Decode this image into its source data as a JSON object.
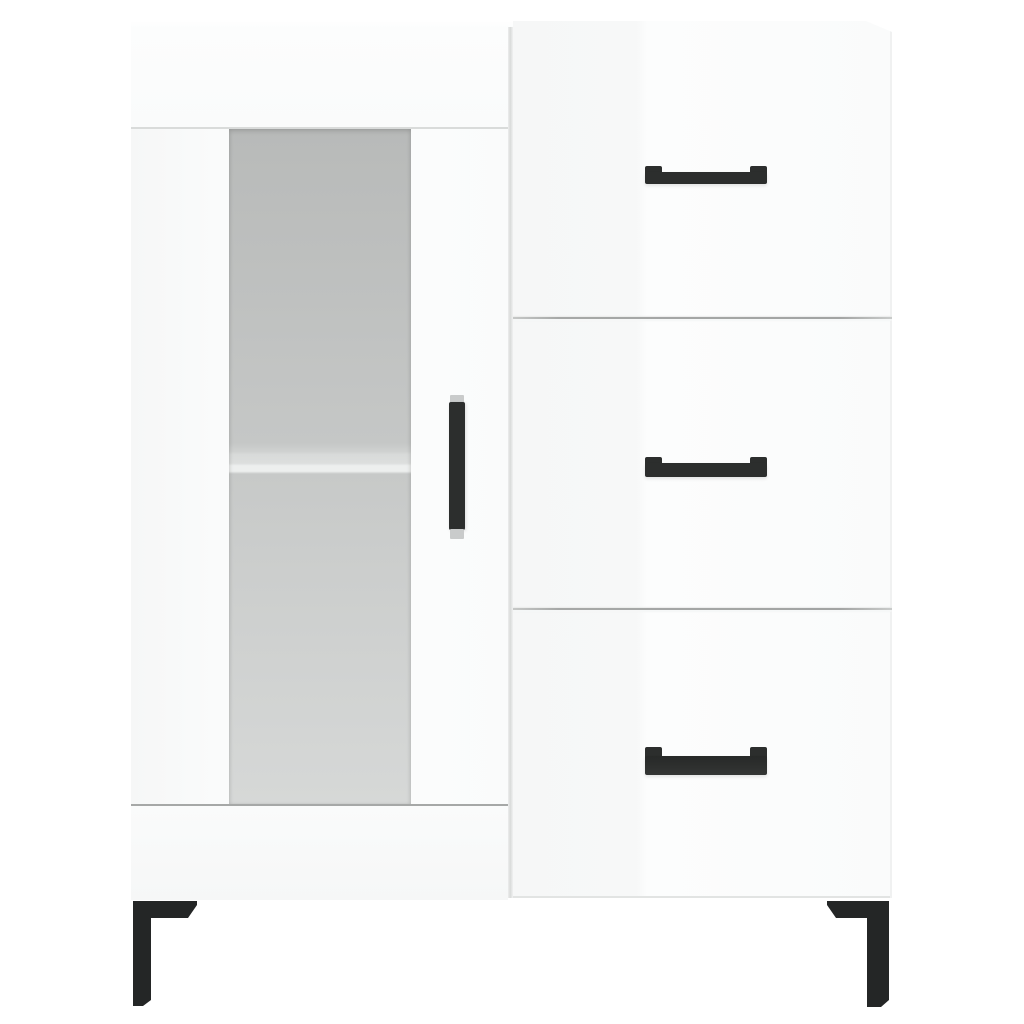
{
  "scene": {
    "type": "product-photo",
    "description": "Studio product photograph of a white high-gloss sideboard (highboard) with a frosted-glass door on the left, three drawers on the right, black bar handles and black metal corner legs, on a plain white background"
  },
  "colors": {
    "bg": "#ffffff",
    "body": "#fafbfb",
    "body-bright": "#fcfdfd",
    "body-shade": "#f6f7f7",
    "rail-line": "#d9dbda",
    "gap-line": "#a6a8a7",
    "bottom-line": "#e2e4e3",
    "edge-soft": "#f0f1f1",
    "glass-top": "#b8bab9",
    "glass-mid": "#c5c7c6",
    "shelf-face": "#d8dad9",
    "shelf-highlight": "#edefee",
    "glass-lower": "#c7c9c8",
    "glass-bottom": "#d6d8d7",
    "handle": "#2c2e2d",
    "handle-mount": "#c9cbcb",
    "leg": "#242626"
  },
  "cabinet": {
    "label": "white sideboard with glass door and three drawers",
    "top_surface_label": "cabinet top surface",
    "door_section": {
      "label": "left door section",
      "top_rail_label": "top rail above door",
      "door_label": "glass door",
      "glass_label": "frosted glass panel",
      "shelf_label": "shelf edge seen through glass",
      "handle_label": "vertical black door handle",
      "bottom_rail_label": "bottom rail below door"
    },
    "divider_label": "gap between door and drawers",
    "drawer_section": {
      "label": "right drawer section",
      "drawers": [
        {
          "label": "top drawer",
          "handle_label": "black bar handle of top drawer"
        },
        {
          "label": "middle drawer",
          "handle_label": "black bar handle of middle drawer"
        },
        {
          "label": "bottom drawer",
          "handle_label": "black bar handle of bottom drawer"
        }
      ],
      "divider_labels": [
        "seam between top and middle drawer",
        "seam between middle and bottom drawer"
      ]
    },
    "legs": {
      "left_label": "black metal corner leg, front left",
      "right_label": "black metal corner leg, front right"
    }
  }
}
